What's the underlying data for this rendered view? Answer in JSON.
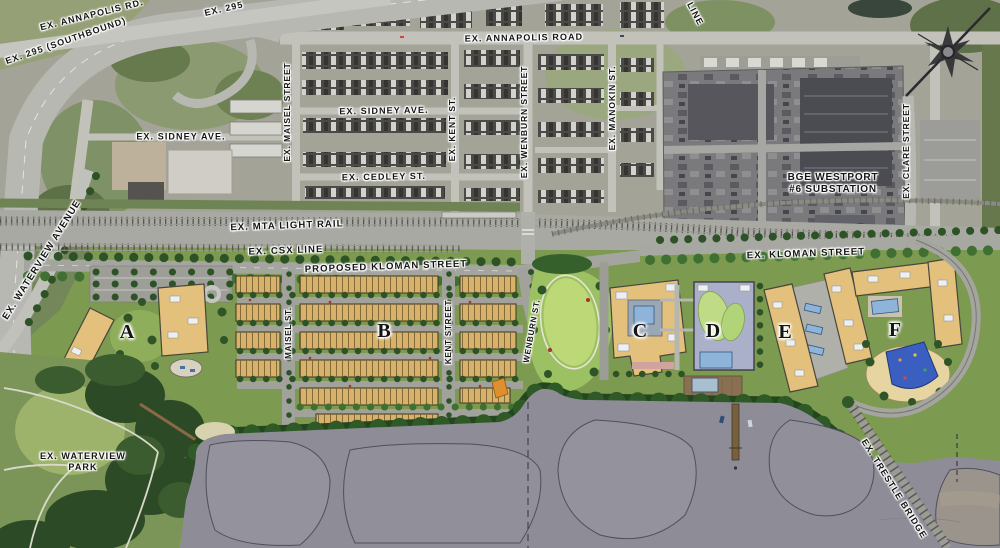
{
  "labels": {
    "annapolis_rd_diag": "EX. ANNAPOLIS RD.",
    "route_295_southbound": "EX. 295 (SOUTHBOUND)",
    "route_295": "EX. 295",
    "line_partial": "LINE",
    "annapolis_road": "EX. ANNAPOLIS ROAD",
    "sidney_ave_left": "EX. SIDNEY AVE.",
    "sidney_ave": "EX. SIDNEY AVE.",
    "cedley_st": "EX. CEDLEY ST.",
    "maisel_street_ex": "EX. MAISEL STREET",
    "kent_st_ex": "EX. KENT ST.",
    "wenburn_street_ex": "EX. WENBURN STREET",
    "manokin_st_ex": "EX. MANOKIN ST.",
    "clare_street_ex": "EX. CLARE STREET",
    "bge_line1": "BGE WESTPORT",
    "bge_line2": "#6 SUBSTATION",
    "mta_light_rail": "EX. MTA LIGHT RAIL",
    "csx_line": "EX. CSX LINE",
    "proposed_kloman": "PROPOSED KLOMAN STREET",
    "ex_kloman": "EX. KLOMAN STREET",
    "waterview_avenue": "EX. WATERVIEW AVENUE",
    "waterview_park_line1": "EX. WATERVIEW",
    "waterview_park_line2": "PARK",
    "trestle_bridge": "EX. TRESTLE BRIDGE",
    "maisel_st_site": "MAISEL ST.",
    "kent_street_site": "KENT STREET",
    "wenburn_st_site": "WENBURN ST.",
    "block_a": "A",
    "block_b": "B",
    "block_c": "C",
    "block_d": "D",
    "block_e": "E",
    "block_f": "F"
  },
  "development_blocks": [
    "A",
    "B",
    "C",
    "D",
    "E",
    "F"
  ],
  "colors": {
    "water": "#8d8c97",
    "water_contour": "#504f5b",
    "site_green": "#7c9a50",
    "forest_green": "#2c4a26",
    "lawn_green": "#bcd877",
    "building_tan": "#e3c17c",
    "townhome_tan": "#d8b26a",
    "pool_blue": "#8fb4d9",
    "playground_blue": "#3b5fc0",
    "road_gray": "#a2a29c",
    "aerial_gray": "#a3a497",
    "label_color": "#141414"
  }
}
